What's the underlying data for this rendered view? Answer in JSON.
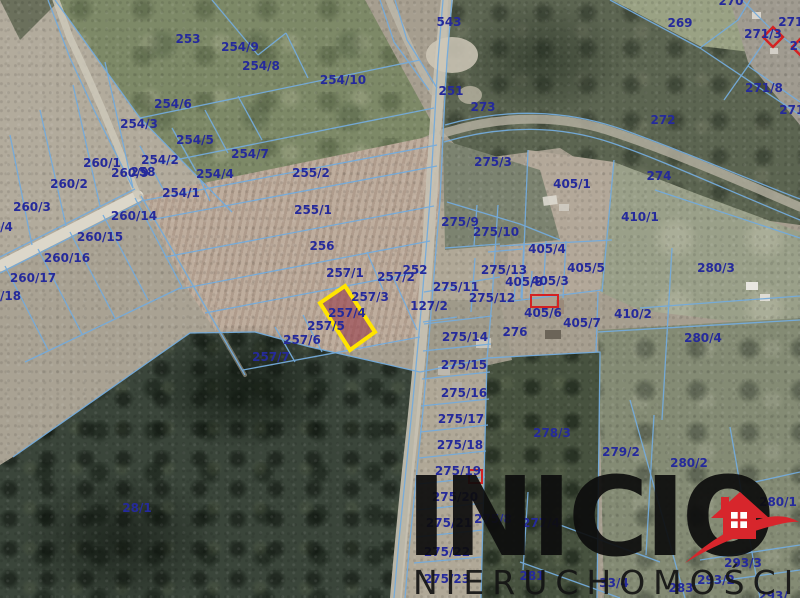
{
  "map": {
    "highlighted_parcel": "257/4",
    "label_color": "#252a9b",
    "boundary_color": "#74abdc",
    "marker_color": "#d42222",
    "highlight": {
      "parcel": "257/4",
      "stroke": "#ffe400",
      "fill": "rgba(153,64,78,0.62)",
      "polygon": [
        [
          345,
          286
        ],
        [
          375,
          332
        ],
        [
          350,
          350
        ],
        [
          320,
          303
        ]
      ]
    },
    "markers": [
      {
        "type": "rect",
        "name": "red-outline-405-6",
        "x": 531,
        "y": 295,
        "w": 27,
        "h": 12
      },
      {
        "type": "rect",
        "name": "red-outline-275-19",
        "x": 469,
        "y": 470,
        "w": 13,
        "h": 13
      },
      {
        "type": "diamond",
        "name": "red-diamond-271-3",
        "cx": 773,
        "cy": 37,
        "size": 14
      },
      {
        "type": "diamond",
        "name": "red-diamond-edge",
        "cx": 800,
        "cy": 47,
        "size": 11
      }
    ],
    "parcels": [
      {
        "id": "253",
        "x": 188,
        "y": 39
      },
      {
        "id": "254/9",
        "x": 240,
        "y": 47
      },
      {
        "id": "254/8",
        "x": 261,
        "y": 66
      },
      {
        "id": "254/10",
        "x": 343,
        "y": 80
      },
      {
        "id": "254/6",
        "x": 173,
        "y": 104
      },
      {
        "id": "254/3",
        "x": 139,
        "y": 124
      },
      {
        "id": "254/5",
        "x": 195,
        "y": 140
      },
      {
        "id": "254/2",
        "x": 160,
        "y": 160
      },
      {
        "id": "254/7",
        "x": 250,
        "y": 154
      },
      {
        "id": "254/4",
        "x": 215,
        "y": 174
      },
      {
        "id": "254/1",
        "x": 181,
        "y": 193
      },
      {
        "id": "260/1",
        "x": 102,
        "y": 163
      },
      {
        "id": "260/2",
        "x": 69,
        "y": 184
      },
      {
        "id": "260/3",
        "x": 32,
        "y": 207
      },
      {
        "id": "260/4",
        "x": -6,
        "y": 227
      },
      {
        "id": "260/9",
        "x": 130,
        "y": 173
      },
      {
        "id": "258",
        "x": 143,
        "y": 172
      },
      {
        "id": "260/14",
        "x": 134,
        "y": 216
      },
      {
        "id": "260/15",
        "x": 100,
        "y": 237
      },
      {
        "id": "260/16",
        "x": 67,
        "y": 258
      },
      {
        "id": "260/17",
        "x": 33,
        "y": 278
      },
      {
        "id": "260/18",
        "x": -2,
        "y": 296
      },
      {
        "id": "255/2",
        "x": 311,
        "y": 173
      },
      {
        "id": "255/1",
        "x": 313,
        "y": 210
      },
      {
        "id": "256",
        "x": 322,
        "y": 246
      },
      {
        "id": "257/1",
        "x": 345,
        "y": 273
      },
      {
        "id": "257/2",
        "x": 396,
        "y": 277
      },
      {
        "id": "252",
        "x": 415,
        "y": 270
      },
      {
        "id": "257/3",
        "x": 370,
        "y": 297
      },
      {
        "id": "257/4",
        "x": 347,
        "y": 313
      },
      {
        "id": "257/5",
        "x": 326,
        "y": 326
      },
      {
        "id": "257/6",
        "x": 302,
        "y": 340
      },
      {
        "id": "257/7",
        "x": 271,
        "y": 357
      },
      {
        "id": "127/2",
        "x": 429,
        "y": 306
      },
      {
        "id": "543",
        "x": 449,
        "y": 22
      },
      {
        "id": "251",
        "x": 451,
        "y": 91
      },
      {
        "id": "273",
        "x": 483,
        "y": 107
      },
      {
        "id": "270",
        "x": 731,
        "y": 1
      },
      {
        "id": "269",
        "x": 680,
        "y": 23
      },
      {
        "id": "271/",
        "x": 793,
        "y": 22
      },
      {
        "id": "271/3",
        "x": 763,
        "y": 34
      },
      {
        "id": "27",
        "x": 798,
        "y": 46
      },
      {
        "id": "271/8",
        "x": 764,
        "y": 88
      },
      {
        "id": "271/",
        "x": 794,
        "y": 110
      },
      {
        "id": "272",
        "x": 663,
        "y": 120
      },
      {
        "id": "274",
        "x": 659,
        "y": 176
      },
      {
        "id": "275/3",
        "x": 493,
        "y": 162
      },
      {
        "id": "405/1",
        "x": 572,
        "y": 184
      },
      {
        "id": "410/1",
        "x": 640,
        "y": 217
      },
      {
        "id": "275/9",
        "x": 460,
        "y": 222
      },
      {
        "id": "275/10",
        "x": 496,
        "y": 232
      },
      {
        "id": "405/4",
        "x": 547,
        "y": 249
      },
      {
        "id": "405/5",
        "x": 586,
        "y": 268
      },
      {
        "id": "275/13",
        "x": 504,
        "y": 270
      },
      {
        "id": "405/8",
        "x": 524,
        "y": 282
      },
      {
        "id": "405/3",
        "x": 550,
        "y": 281
      },
      {
        "id": "275/11",
        "x": 456,
        "y": 287
      },
      {
        "id": "275/12",
        "x": 492,
        "y": 298
      },
      {
        "id": "405/6",
        "x": 543,
        "y": 313
      },
      {
        "id": "405/7",
        "x": 582,
        "y": 323
      },
      {
        "id": "410/2",
        "x": 633,
        "y": 314
      },
      {
        "id": "280/3",
        "x": 716,
        "y": 268
      },
      {
        "id": "280/4",
        "x": 703,
        "y": 338
      },
      {
        "id": "276",
        "x": 515,
        "y": 332
      },
      {
        "id": "275/14",
        "x": 465,
        "y": 337
      },
      {
        "id": "275/15",
        "x": 464,
        "y": 365
      },
      {
        "id": "275/16",
        "x": 464,
        "y": 393
      },
      {
        "id": "275/17",
        "x": 461,
        "y": 419
      },
      {
        "id": "275/18",
        "x": 460,
        "y": 445
      },
      {
        "id": "275/19",
        "x": 458,
        "y": 471
      },
      {
        "id": "278/3",
        "x": 552,
        "y": 433
      },
      {
        "id": "279/2",
        "x": 621,
        "y": 452
      },
      {
        "id": "280/2",
        "x": 689,
        "y": 463
      },
      {
        "id": "28/1",
        "x": 137,
        "y": 508
      },
      {
        "id": "275/20",
        "x": 455,
        "y": 497
      },
      {
        "id": "275/21",
        "x": 449,
        "y": 523
      },
      {
        "id": "275/8",
        "x": 493,
        "y": 519
      },
      {
        "id": "277/4",
        "x": 541,
        "y": 523
      },
      {
        "id": "275/22",
        "x": 447,
        "y": 552
      },
      {
        "id": "275/23",
        "x": 447,
        "y": 579
      },
      {
        "id": "281",
        "x": 532,
        "y": 576
      },
      {
        "id": "33/4",
        "x": 614,
        "y": 583
      },
      {
        "id": "283",
        "x": 681,
        "y": 588
      },
      {
        "id": "293/2",
        "x": 716,
        "y": 580
      },
      {
        "id": "293/3",
        "x": 743,
        "y": 563
      },
      {
        "id": "280/1",
        "x": 778,
        "y": 502
      },
      {
        "id": "293/",
        "x": 773,
        "y": 596
      }
    ]
  },
  "watermark": {
    "brand": "INICIO",
    "tagline": "NIERUCHOMOŚCI",
    "text_color": "#111111",
    "logo_color": "#d7262c"
  }
}
